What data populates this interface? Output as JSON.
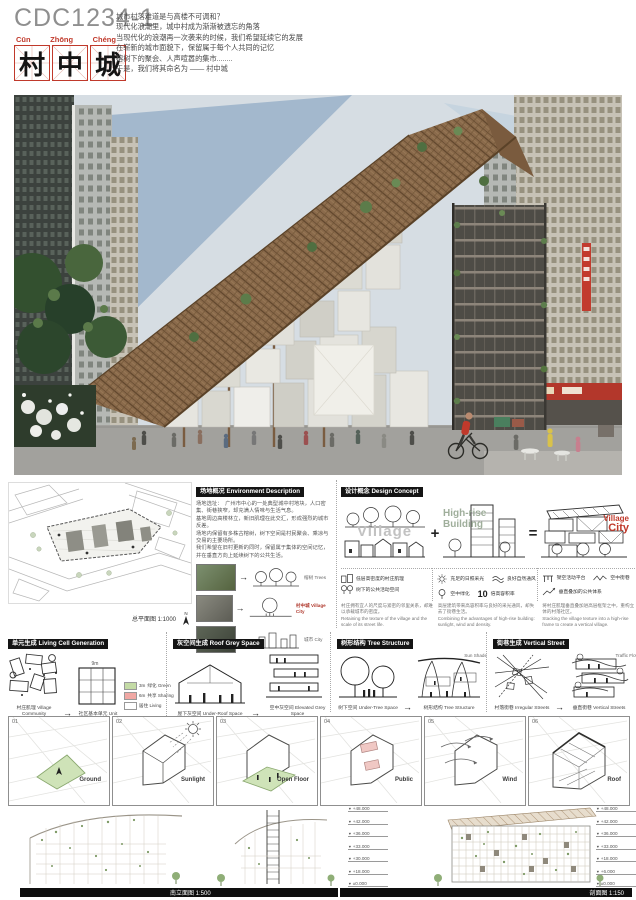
{
  "board": {
    "code": "CDC1234-1",
    "pinyin": [
      "Cūn",
      "Zhōng",
      "Chéng"
    ],
    "title_chars": [
      "村",
      "中",
      "城"
    ],
    "intro_lines": [
      "城市村落难道是与高楼不可调和？",
      "现代化浪潮里，城中村成为渐渐被遗忘的角落",
      "当现代化的浪潮再一次袭来的时候，我们希望延续它的发展",
      "在崭新的城市面貌下，保留属于每个人共同的记忆",
      "榕树下的聚会、人声喧嚣的集市........",
      "于是，我们将其命名为 —— 村中城"
    ]
  },
  "symbols": {
    "arrow": "→",
    "plus": "+",
    "equals": "=",
    "level_marker": "▼",
    "north": "N"
  },
  "site": {
    "header": "场地概况 Environment Description",
    "plan_caption": "总平面图 1:1000",
    "desc_lines": [
      "场地选址：　广州市中心的一处典型城中村地块，人口密集、街巷狭窄，却充满人情味与生活气息。",
      "基地周边高楼林立，新旧肌理在此交汇，形成强烈的城市反差。",
      "场地内保留有多株古榕树，树下空间是村民聚会、乘凉与交易的主要场所。",
      "我们希望在旧村更新的同时，保留属于集体的空间记忆，并在垂直方向上延续树下的公共生活。"
    ],
    "labels": {
      "trees": "榕树 Trees",
      "city": "城市 City",
      "combined": "村中城 Village City"
    }
  },
  "concept": {
    "header": "设计概念 Design Concept",
    "columns": [
      {
        "title": "Village",
        "icons": [
          {
            "name": "houses",
            "label": "低层高密度的村庄肌理"
          },
          {
            "name": "trees",
            "label": "树下的公共活动空间"
          }
        ],
        "desc_cn": "村庄拥有宜人的尺度与紧密的邻里关系，却难以承载城市的密度。",
        "desc_en": "Retaining the texture of the village and the scale of its street life."
      },
      {
        "title_1": "High-rise",
        "title_2": "Building",
        "icons": [
          {
            "name": "sun",
            "label": "充足的日照采光"
          },
          {
            "name": "wind",
            "label": "良好自然通风"
          },
          {
            "name": "tree",
            "label": "空中绿化"
          },
          {
            "name": "number-10",
            "value": "10",
            "label": "倍高容积率"
          }
        ],
        "desc_cn": "高层建筑带来高容积率与良好的采光通风，却失去了街巷生活。",
        "desc_en": "Combining the advantages of high-rise building: sunlight, wind and density."
      },
      {
        "title_1": "Village",
        "title_2": "City",
        "icons": [
          {
            "name": "platform",
            "label": "架空活动平台"
          },
          {
            "name": "sky-street",
            "label": "空中街巷"
          },
          {
            "name": "network",
            "label": "垂直叠加的公共体系"
          }
        ],
        "desc_cn": "将村庄肌理垂直叠加进高层框架之中，重构立体的村落社区。",
        "desc_en": "Stacking the village texture into a high-rise frame to create a vertical village."
      }
    ]
  },
  "modules": [
    {
      "header": "单元生成 Living Cell Generation",
      "from_label": "村庄肌理 Village Community",
      "to_label": "社区基本单元 Unit",
      "dims": [
        "9m",
        "3m",
        "6m"
      ],
      "legend": [
        {
          "label": "绿化 Green"
        },
        {
          "label": "共享 Sharing"
        },
        {
          "label": "居住 Living"
        }
      ]
    },
    {
      "header": "灰空间生成 Roof Grey Space",
      "from_label": "屋下灰空间 Under-Roof Space",
      "to_label": "空中灰空间 Elevated Grey Space"
    },
    {
      "header": "树形结构 Tree Structure",
      "from_label": "树下空间 Under-Tree Space",
      "to_label": "树形结构 Tree Structure",
      "note": "Sun Shade"
    },
    {
      "header": "街巷生成 Vertical Street",
      "from_label": "村落街巷 Irregular Streets",
      "to_label": "垂直街巷 Vertical Streets",
      "note": "Traffic Flow"
    }
  ],
  "process": {
    "panels": [
      {
        "num": "01",
        "label": "Ground"
      },
      {
        "num": "02",
        "label": "Sunlight"
      },
      {
        "num": "03",
        "label": "Open Floor"
      },
      {
        "num": "04",
        "label": "Public"
      },
      {
        "num": "05",
        "label": "Wind"
      },
      {
        "num": "06",
        "label": "Roof"
      }
    ]
  },
  "drawings": {
    "caption_left": "南立面图 1:500",
    "caption_right": "剖面图 1:150",
    "levels_left": [
      "+48.000",
      "+42.000",
      "+36.000",
      "+33.000",
      "+30.000",
      "+18.000",
      "±0.000"
    ],
    "levels_right": [
      "+48.000",
      "+42.000",
      "+36.000",
      "+33.000",
      "+18.000",
      "+6.000",
      "±0.000"
    ]
  },
  "colors": {
    "accent_red": "#b03a2e",
    "canopy_brown": "#8a6a4b",
    "foliage_green": "#55713f",
    "sky_blue": "#a9bed2",
    "header_black": "#141414"
  }
}
